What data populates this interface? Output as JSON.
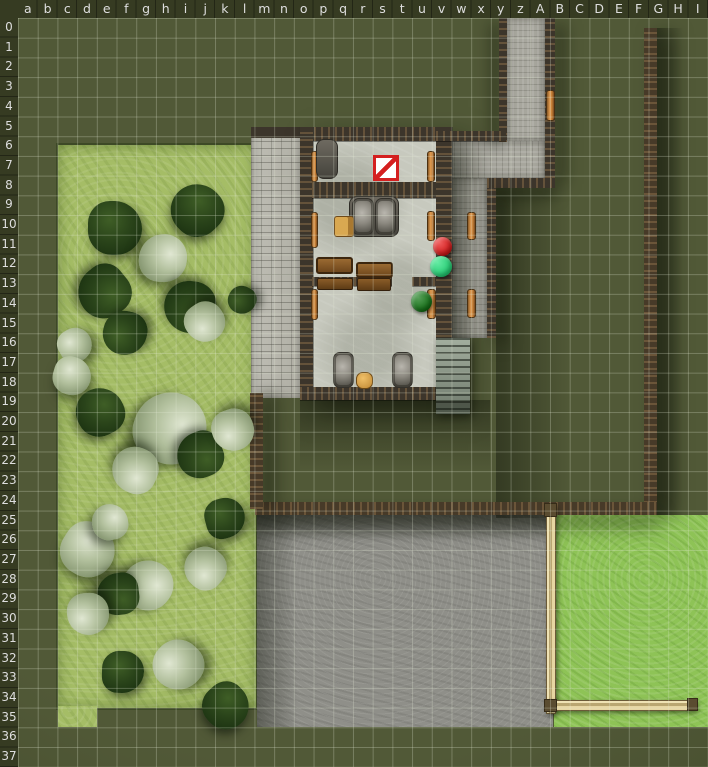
{
  "header": {
    "columns": [
      "a",
      "b",
      "c",
      "d",
      "e",
      "f",
      "g",
      "h",
      "i",
      "j",
      "k",
      "l",
      "m",
      "n",
      "o",
      "p",
      "q",
      "r",
      "s",
      "t",
      "u",
      "v",
      "w",
      "x",
      "y",
      "z",
      "A",
      "B",
      "C",
      "D",
      "E",
      "F",
      "G",
      "H",
      "I"
    ],
    "rows": [
      "0",
      "1",
      "2",
      "3",
      "4",
      "5",
      "6",
      "7",
      "8",
      "9",
      "10",
      "11",
      "12",
      "13",
      "14",
      "15",
      "16",
      "17",
      "18",
      "19",
      "20",
      "21",
      "22",
      "23",
      "24",
      "25",
      "26",
      "27",
      "28",
      "29",
      "30",
      "31",
      "32",
      "33",
      "34",
      "35",
      "36",
      "37"
    ]
  },
  "grid": {
    "cols": 35,
    "rows": 38,
    "cell_w": 19.714,
    "cell_h": 19.711,
    "origin_x": 18,
    "origin_y": 18
  },
  "palette": {
    "header_bg": "#363b22",
    "header_text": "#dedede",
    "base_olive": "#4a522f",
    "field_green": "#a5bd66",
    "bright_grass": "#8ec356",
    "courtyard_gray": "#8f8f89",
    "street_gray": "#b6b5ab",
    "floor_gray": "#c7c9be",
    "wall_brown": "#3c352b",
    "compound_wall": "#473a28",
    "bench_orange": "#d08a3e",
    "fence_tan": "#d8c795",
    "token_red": "#e81616",
    "token_green": "#22e27c",
    "token_dark_green": "#107712",
    "hazard_red": "#d42020"
  },
  "tokens": [
    {
      "name": "hazard-marker-token",
      "shape": "square-slash",
      "grid_ref": "s7",
      "x": 373,
      "y": 155,
      "w": 26,
      "h": 26,
      "fill": "#ffffff",
      "stroke": "#d42020"
    },
    {
      "name": "red-round-token",
      "shape": "circle",
      "grid_ref": "v11",
      "x": 433,
      "y": 237,
      "w": 19,
      "h": 19,
      "fill": "#e81616"
    },
    {
      "name": "green-round-token",
      "shape": "circle",
      "grid_ref": "v12",
      "x": 430,
      "y": 256,
      "w": 22,
      "h": 21,
      "fill": "#22e27c"
    },
    {
      "name": "dark-green-round-token",
      "shape": "circle",
      "grid_ref": "u14",
      "x": 411,
      "y": 291,
      "w": 21,
      "h": 21,
      "fill": "#107712"
    }
  ],
  "scenery": {
    "trees": [
      {
        "x": 115,
        "y": 228,
        "r": 27,
        "kind": "dark"
      },
      {
        "x": 197,
        "y": 210,
        "r": 26,
        "kind": "dark"
      },
      {
        "x": 163,
        "y": 258,
        "r": 24,
        "kind": "pale"
      },
      {
        "x": 104,
        "y": 292,
        "r": 26,
        "kind": "dark"
      },
      {
        "x": 190,
        "y": 307,
        "r": 26,
        "kind": "dark"
      },
      {
        "x": 205,
        "y": 322,
        "r": 20,
        "kind": "pale"
      },
      {
        "x": 125,
        "y": 333,
        "r": 22,
        "kind": "dark"
      },
      {
        "x": 75,
        "y": 345,
        "r": 17,
        "kind": "pale"
      },
      {
        "x": 72,
        "y": 376,
        "r": 19,
        "kind": "pale"
      },
      {
        "x": 100,
        "y": 412,
        "r": 24,
        "kind": "dark"
      },
      {
        "x": 170,
        "y": 428,
        "r": 36,
        "kind": "pale"
      },
      {
        "x": 200,
        "y": 455,
        "r": 23,
        "kind": "dark"
      },
      {
        "x": 135,
        "y": 470,
        "r": 23,
        "kind": "pale"
      },
      {
        "x": 233,
        "y": 430,
        "r": 21,
        "kind": "pale"
      },
      {
        "x": 242,
        "y": 300,
        "r": 14,
        "kind": "dark"
      },
      {
        "x": 225,
        "y": 518,
        "r": 20,
        "kind": "dark"
      },
      {
        "x": 88,
        "y": 550,
        "r": 27,
        "kind": "pale"
      },
      {
        "x": 110,
        "y": 522,
        "r": 18,
        "kind": "pale"
      },
      {
        "x": 148,
        "y": 585,
        "r": 25,
        "kind": "pale"
      },
      {
        "x": 118,
        "y": 594,
        "r": 21,
        "kind": "dark"
      },
      {
        "x": 205,
        "y": 568,
        "r": 21,
        "kind": "pale"
      },
      {
        "x": 88,
        "y": 614,
        "r": 21,
        "kind": "pale"
      },
      {
        "x": 178,
        "y": 665,
        "r": 25,
        "kind": "pale"
      },
      {
        "x": 123,
        "y": 672,
        "r": 21,
        "kind": "dark"
      },
      {
        "x": 226,
        "y": 706,
        "r": 23,
        "kind": "dark"
      }
    ],
    "furniture": [
      {
        "kind": "bench",
        "x": 311,
        "y": 151,
        "w": 7,
        "h": 31
      },
      {
        "kind": "bench",
        "x": 427,
        "y": 151,
        "w": 8,
        "h": 31
      },
      {
        "kind": "bench",
        "x": 311,
        "y": 212,
        "w": 7,
        "h": 36
      },
      {
        "kind": "bench",
        "x": 427,
        "y": 211,
        "w": 8,
        "h": 30
      },
      {
        "kind": "bench",
        "x": 467,
        "y": 212,
        "w": 9,
        "h": 28
      },
      {
        "kind": "bench",
        "x": 311,
        "y": 289,
        "w": 7,
        "h": 31
      },
      {
        "kind": "bench",
        "x": 427,
        "y": 289,
        "w": 9,
        "h": 30
      },
      {
        "kind": "bench",
        "x": 467,
        "y": 289,
        "w": 9,
        "h": 29
      },
      {
        "kind": "bench",
        "x": 546,
        "y": 90,
        "w": 9,
        "h": 31
      },
      {
        "kind": "counter",
        "x": 316,
        "y": 139,
        "w": 22,
        "h": 40
      },
      {
        "kind": "counter",
        "x": 349,
        "y": 196,
        "w": 50,
        "h": 41
      },
      {
        "kind": "barrel",
        "x": 352,
        "y": 198,
        "w": 22,
        "h": 37
      },
      {
        "kind": "barrel",
        "x": 375,
        "y": 198,
        "w": 21,
        "h": 37
      },
      {
        "kind": "barrel",
        "x": 333,
        "y": 352,
        "w": 21,
        "h": 36
      },
      {
        "kind": "barrel",
        "x": 392,
        "y": 352,
        "w": 21,
        "h": 36
      },
      {
        "kind": "table",
        "x": 316,
        "y": 257,
        "w": 37,
        "h": 17
      },
      {
        "kind": "table",
        "x": 356,
        "y": 262,
        "w": 37,
        "h": 16
      },
      {
        "kind": "tbench",
        "x": 317,
        "y": 278,
        "w": 36,
        "h": 12
      },
      {
        "kind": "tbench",
        "x": 357,
        "y": 278,
        "w": 34,
        "h": 13
      },
      {
        "kind": "chair",
        "x": 334,
        "y": 216,
        "w": 20,
        "h": 21
      },
      {
        "kind": "stool",
        "x": 356,
        "y": 372,
        "w": 17,
        "h": 17
      }
    ]
  }
}
